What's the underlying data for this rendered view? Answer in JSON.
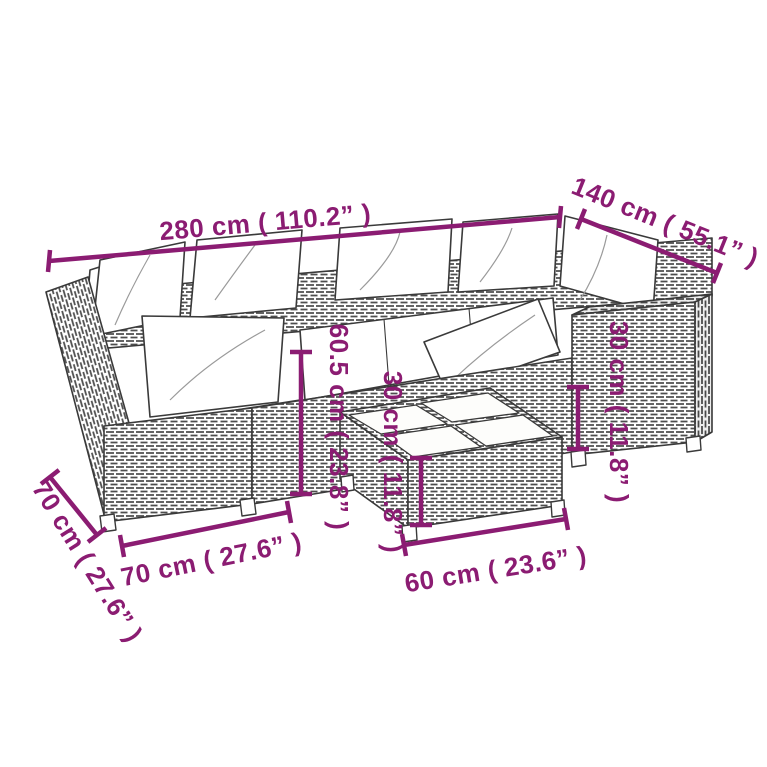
{
  "meta": {
    "description": "Dimension diagram of a rattan garden lounge set with cushions and a cushion-topped coffee table",
    "background_color": "#ffffff",
    "accent_color": "#8B1C72",
    "line_color": "#3a3a3a"
  },
  "annotations": {
    "total_width": "280 cm ( 110.2” )",
    "right_depth": "140 cm ( 55.1” )",
    "back_height": "60.5 cm ( 23.8” )",
    "table_height": "30 cm ( 11.8” )",
    "armrest_height": "30 cm ( 11.8” )",
    "left_depth": "70 cm ( 27.6” )",
    "seat_width": "70 cm ( 27.6” )",
    "table_width": "60 cm ( 23.6” )"
  }
}
